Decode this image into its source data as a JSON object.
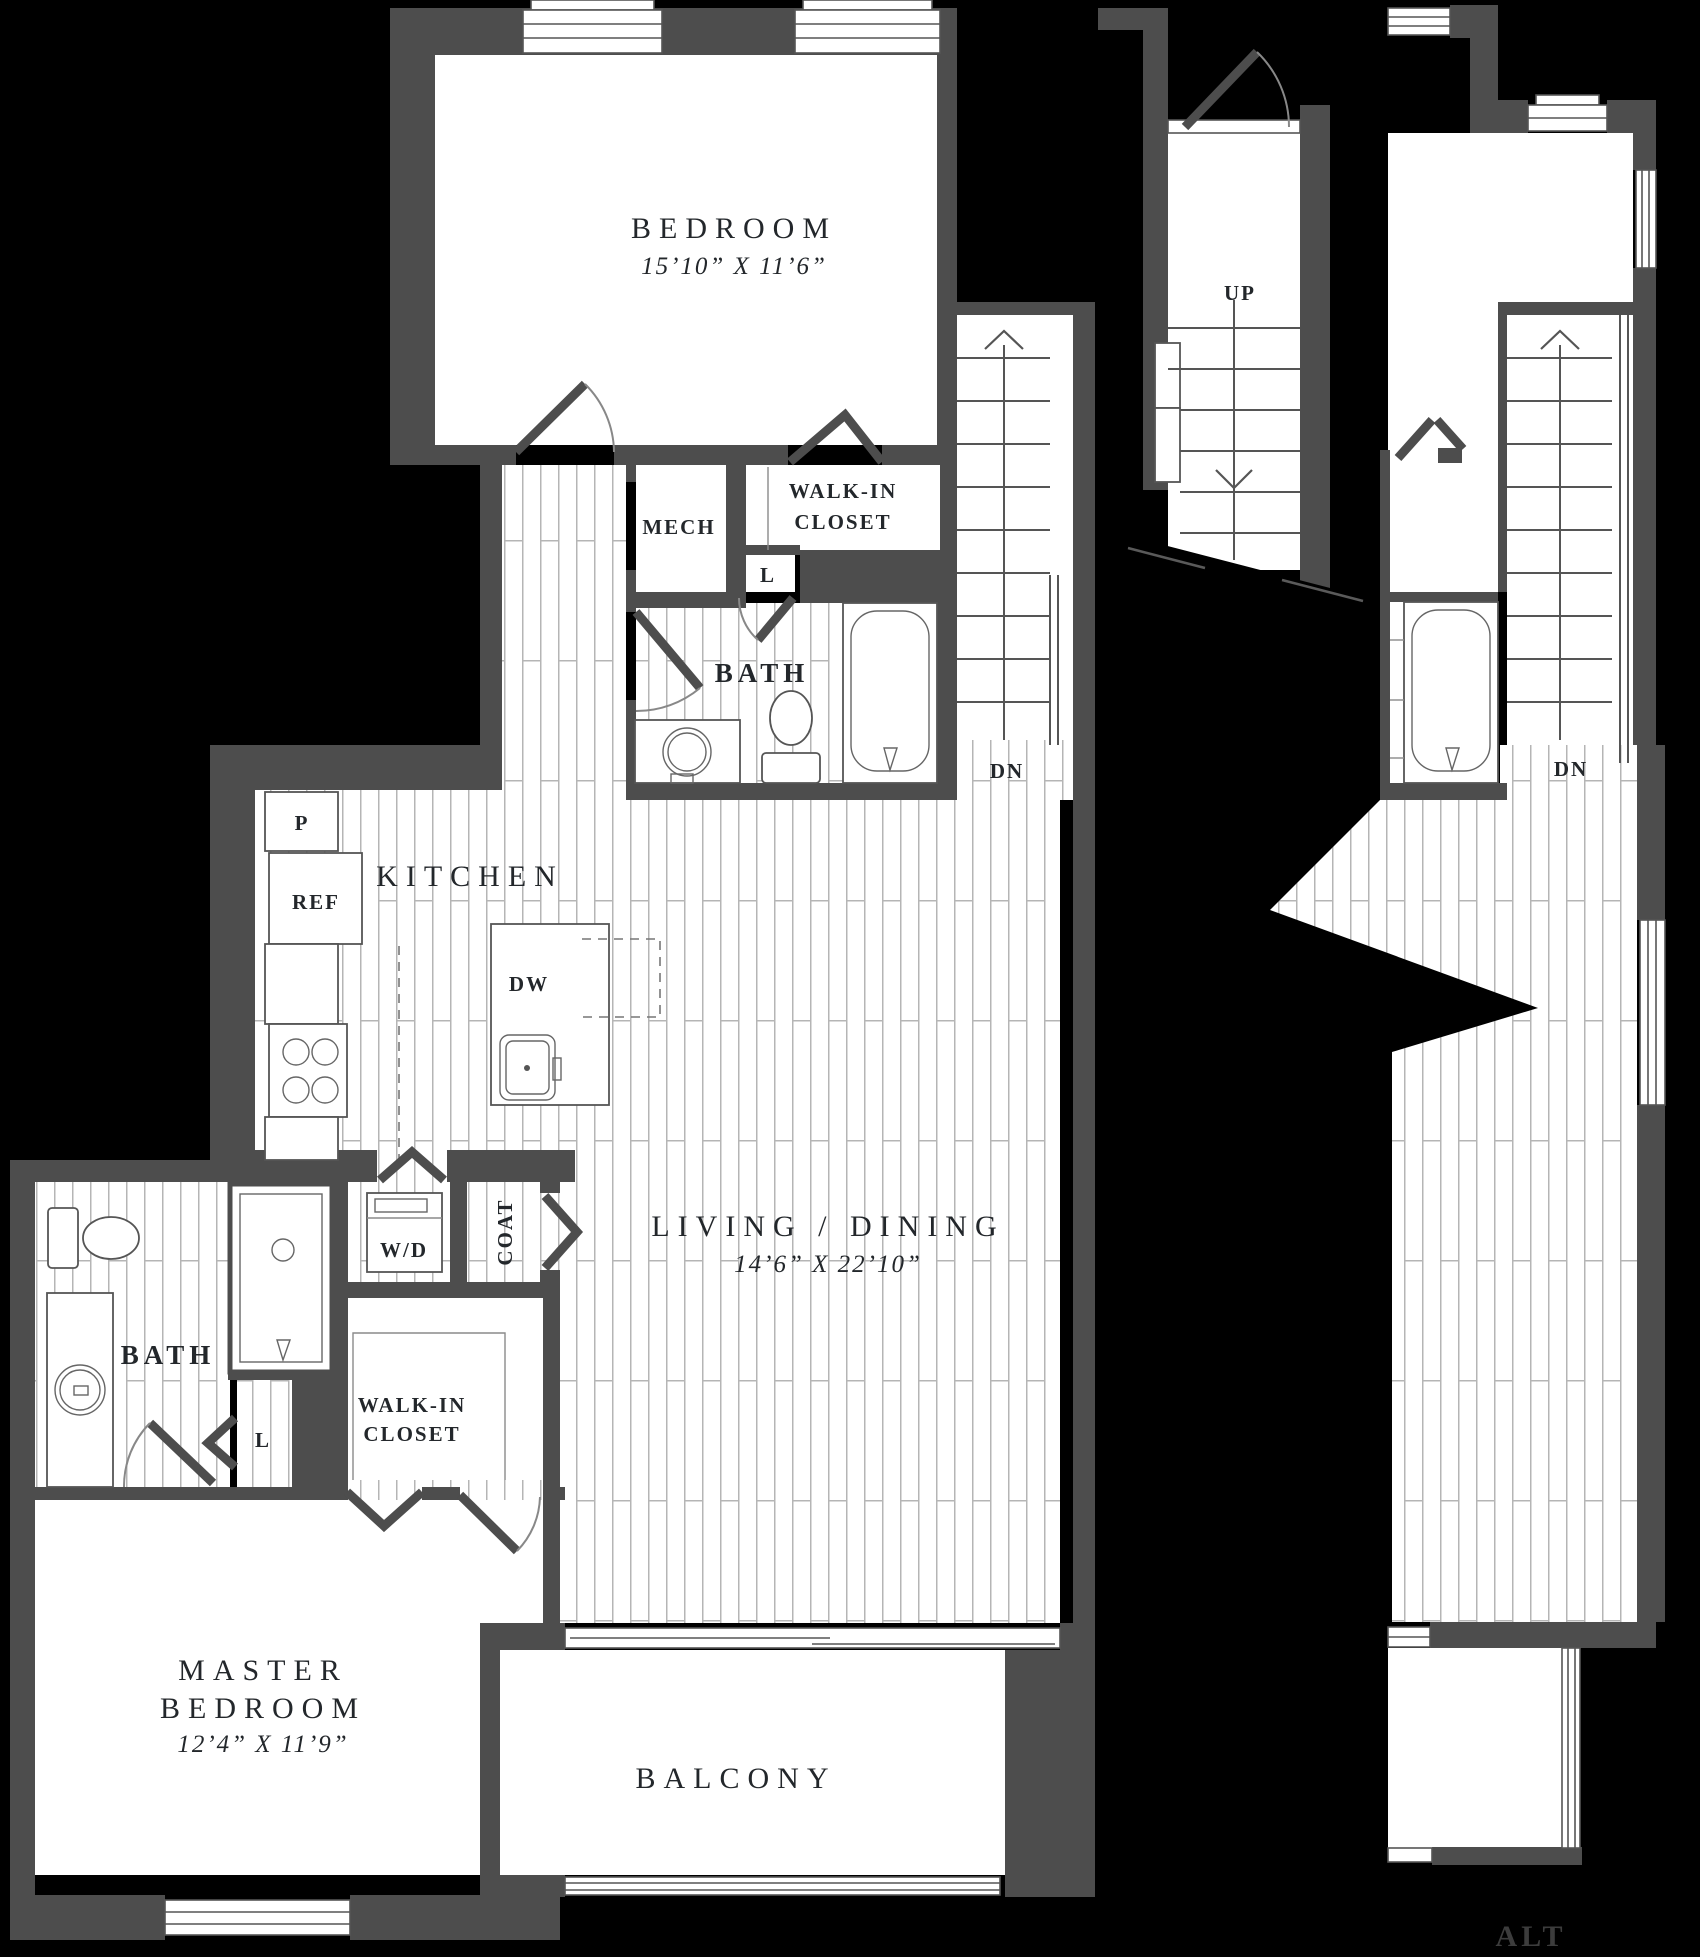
{
  "colors": {
    "background": "#000000",
    "wall": "#4d4d4d",
    "floor": "#ffffff",
    "line": "#555555",
    "text": "#23272b",
    "alt_text": "#3c3c3c"
  },
  "floorplan": {
    "unit": {
      "bedroom": {
        "label": "BEDROOM",
        "dims": "15’10” X 11’6”"
      },
      "walk_in_closet_upper": {
        "line1": "WALK-IN",
        "line2": "CLOSET"
      },
      "mech": {
        "label": "MECH"
      },
      "linen_upper": {
        "label": "L"
      },
      "bath_upper": {
        "label": "BATH"
      },
      "stairs_main": {
        "down_label": "DN"
      },
      "kitchen": {
        "label": "KITCHEN",
        "pantry": "P",
        "refrigerator": "REF",
        "dishwasher": "DW"
      },
      "laundry": {
        "label": "W/D"
      },
      "coat": {
        "label": "COAT"
      },
      "living_dining": {
        "label": "LIVING / DINING",
        "dims": "14’6” X 22’10”"
      },
      "bath_master": {
        "label": "BATH"
      },
      "linen_master": {
        "label": "L"
      },
      "walk_in_closet_master": {
        "line1": "WALK-IN",
        "line2": "CLOSET"
      },
      "master_bedroom": {
        "line1": "MASTER",
        "line2": "BEDROOM",
        "dims": "12’4” X 11’9”"
      },
      "balcony": {
        "label": "BALCONY"
      }
    },
    "entry_stair": {
      "up_label": "UP"
    },
    "alt_panel": {
      "tag": "ALT",
      "stairs": {
        "down_label": "DN"
      }
    }
  }
}
